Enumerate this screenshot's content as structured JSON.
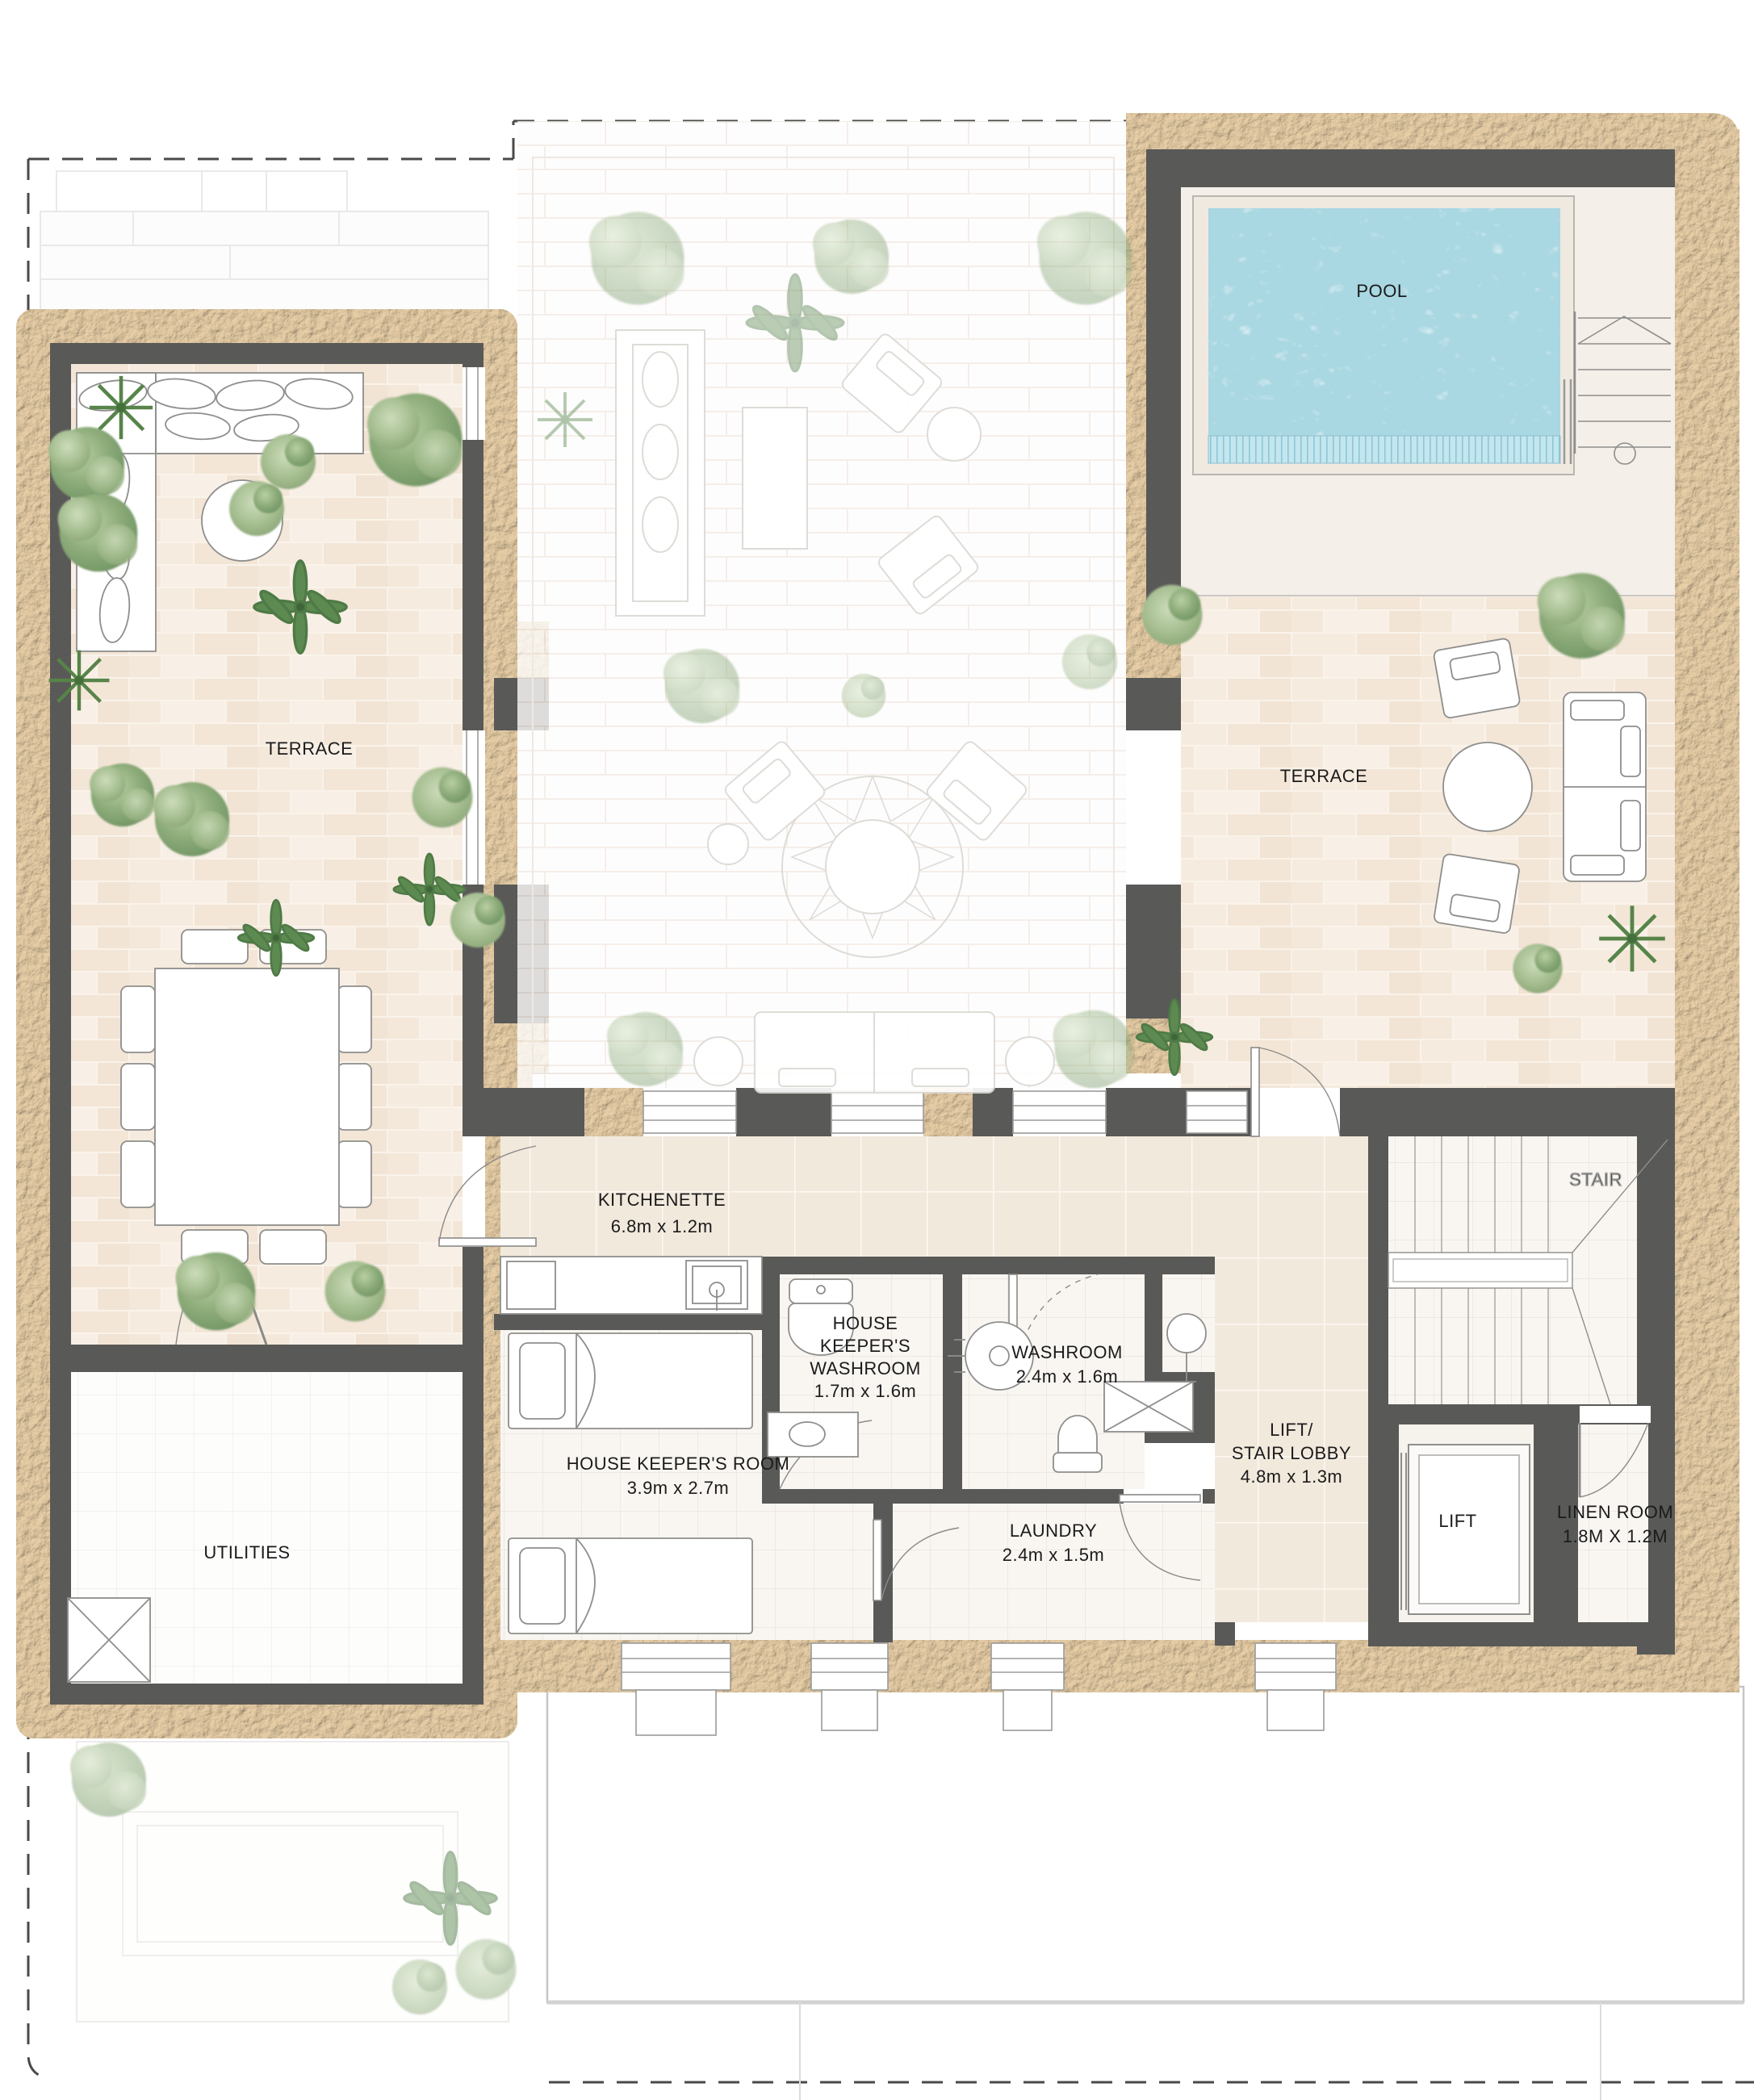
{
  "rooms": {
    "pool": {
      "name": "POOL"
    },
    "terrace_left": {
      "name": "TERRACE"
    },
    "terrace_right": {
      "name": "TERRACE"
    },
    "kitchenette": {
      "name": "KITCHENETTE",
      "dims": "6.8m x 1.2m"
    },
    "hk_washroom": {
      "name_l1": "HOUSE",
      "name_l2": "KEEPER'S",
      "name_l3": "WASHROOM",
      "dims": "1.7m x 1.6m"
    },
    "washroom": {
      "name": "WASHROOM",
      "dims": "2.4m x 1.6m"
    },
    "lobby": {
      "name_l1": "LIFT/",
      "name_l2": "STAIR LOBBY",
      "dims": "4.8m x 1.3m"
    },
    "stair": {
      "name": "STAIR"
    },
    "hk_room": {
      "name": "HOUSE KEEPER'S ROOM",
      "dims": "3.9m x 2.7m"
    },
    "laundry": {
      "name": "LAUNDRY",
      "dims": "2.4m x 1.5m"
    },
    "lift": {
      "name": "LIFT"
    },
    "linen": {
      "name": "LINEN ROOM",
      "dims": "1.8M X 1.2M"
    },
    "utilities": {
      "name": "UTILITIES"
    }
  },
  "colors": {
    "wall": "#595957",
    "sand": "#dcc09c",
    "pool_water": "#a9d7e2",
    "pool_ledge": "#c3e6ef",
    "terrace_paving": "#f6ebdf",
    "interior_floor": "#f9f6f2",
    "corridor_floor": "#f2e9dd",
    "label_text": "#1b1b1b"
  }
}
